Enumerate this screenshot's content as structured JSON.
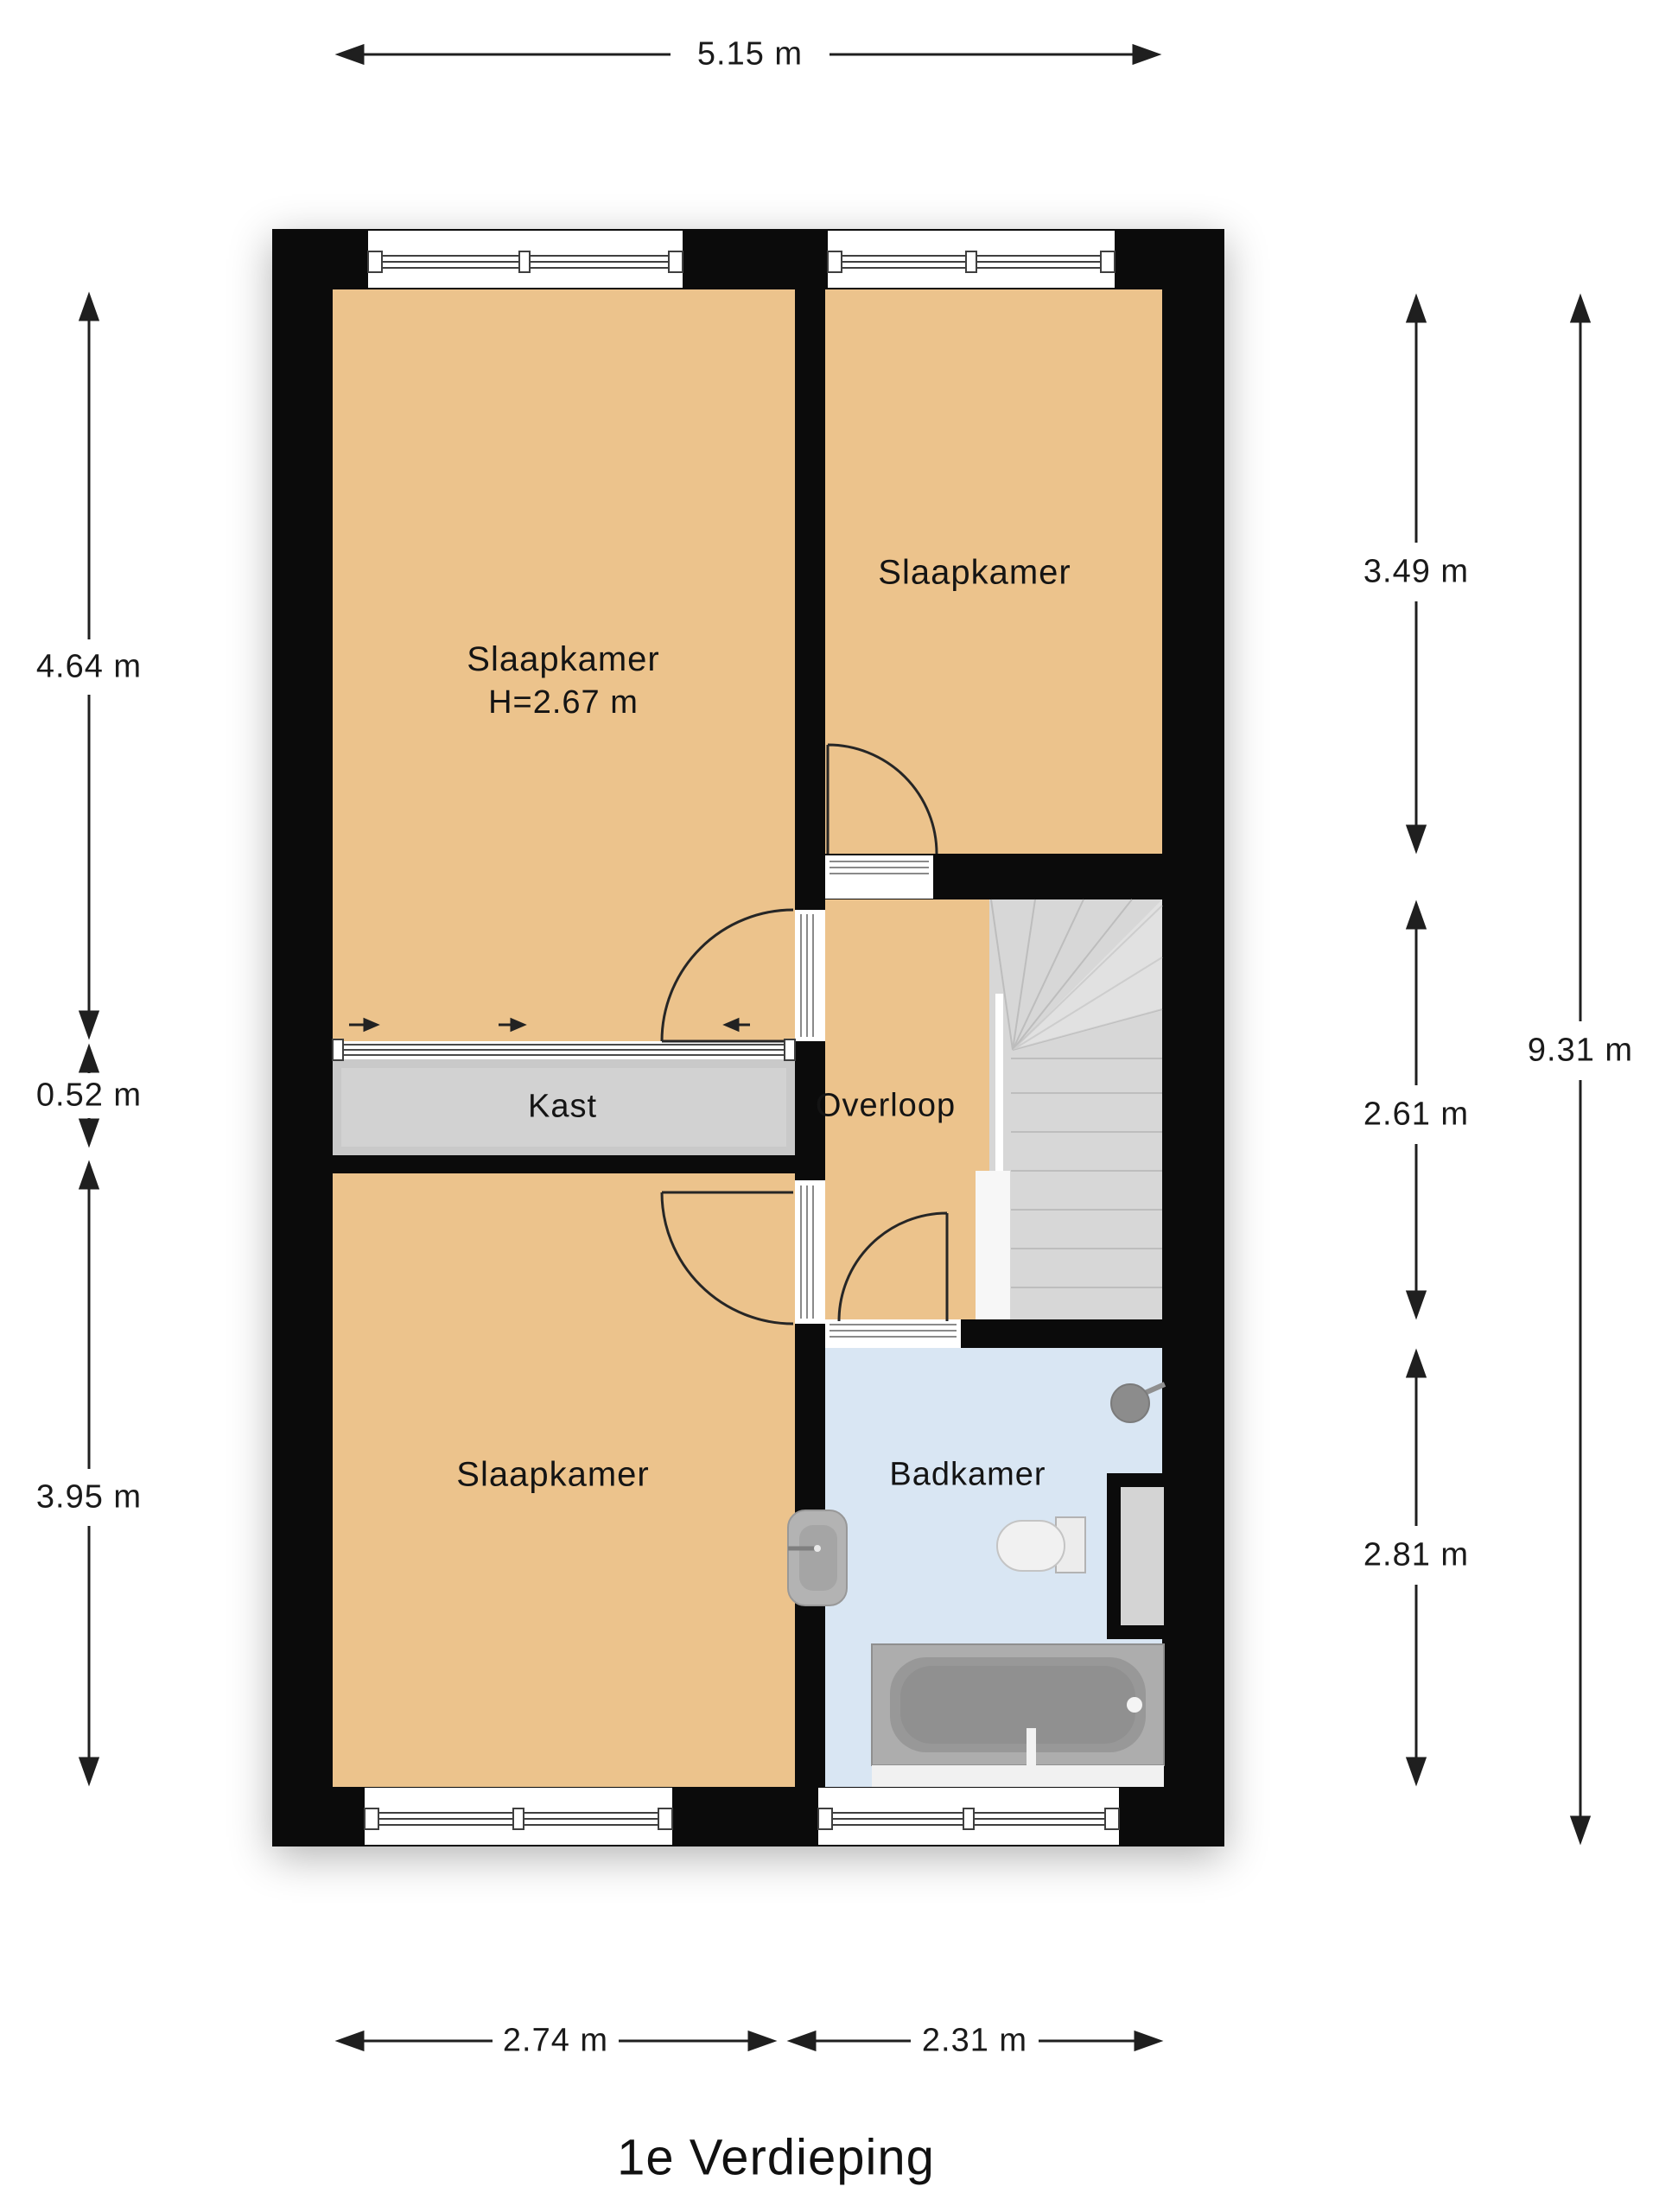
{
  "floor_title": "1e Verdieping",
  "rooms": [
    {
      "name": "slaapkamer-top-left",
      "label": "Slaapkamer",
      "height": "H=2.67 m"
    },
    {
      "name": "slaapkamer-top-right",
      "label": "Slaapkamer"
    },
    {
      "name": "slaapkamer-bottom-left",
      "label": "Slaapkamer"
    },
    {
      "name": "kast",
      "label": "Kast"
    },
    {
      "name": "overloop",
      "label": "Overloop"
    },
    {
      "name": "badkamer",
      "label": "Badkamer"
    }
  ],
  "dimensions": {
    "top": {
      "label": "5.15 m"
    },
    "left": [
      {
        "label": "4.64 m"
      },
      {
        "label": "0.52 m"
      },
      {
        "label": "3.95 m"
      }
    ],
    "right": [
      {
        "label": "3.49 m"
      },
      {
        "label": "2.61 m"
      },
      {
        "label": "2.81 m"
      }
    ],
    "overall_right": {
      "label": "9.31 m"
    },
    "bottom": [
      {
        "label": "2.74 m"
      },
      {
        "label": "2.31 m"
      }
    ]
  },
  "colors": {
    "wall": "#0b0b0b",
    "room_floor": "#ecc38c",
    "closet": "#c9c9c9",
    "stairs": "#d7d7d7",
    "bathroom_floor": "#d9e6f3",
    "annotation_text": "#1a1a1a"
  }
}
